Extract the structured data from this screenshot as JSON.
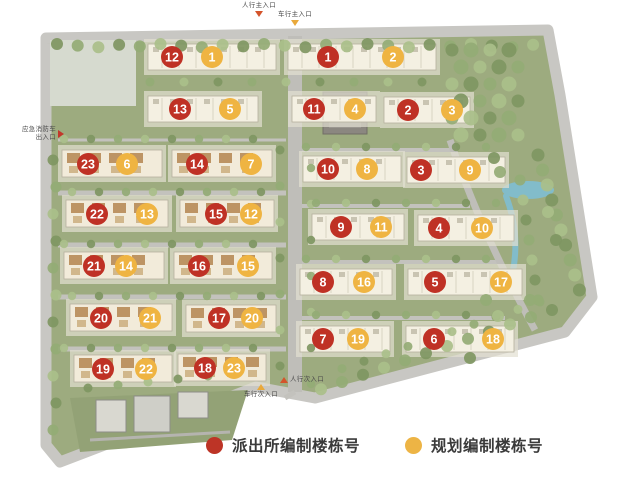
{
  "colors": {
    "red_marker": "#bf3125",
    "orange_marker": "#efb442",
    "legend_red": "#bd3426",
    "legend_orange": "#edb445",
    "pedestrian_triangle": "#d4542b",
    "vehicle_triangle": "#e9a93b",
    "emergency_triangle": "#c2372b"
  },
  "legend": {
    "items": [
      {
        "name": "police-numbering",
        "color": "#bd3426",
        "label": "派出所编制楼栋号"
      },
      {
        "name": "planning-numbering",
        "color": "#edb445",
        "label": "规划编制楼栋号"
      }
    ]
  },
  "entrances": [
    {
      "id": "pedestrian-main",
      "label": "人行主入口",
      "triangle": "down",
      "color": "#d4542b",
      "layout": "label-top",
      "x": 242,
      "y": 2
    },
    {
      "id": "vehicle-main",
      "label": "车行主入口",
      "triangle": "down",
      "color": "#e9a93b",
      "layout": "label-top",
      "x": 278,
      "y": 11
    },
    {
      "id": "emergency-fire",
      "label": "应急消防车出入口",
      "triangle": "right",
      "color": "#c2372b",
      "layout": "label-left",
      "x": 20,
      "y": 126
    },
    {
      "id": "pedestrian-secondary",
      "label": "人行次入口",
      "triangle": "up",
      "color": "#d4542b",
      "layout": "label-right",
      "x": 280,
      "y": 376
    },
    {
      "id": "vehicle-secondary",
      "label": "车行次入口",
      "triangle": "up",
      "color": "#e9a93b",
      "layout": "label-bottom",
      "x": 244,
      "y": 384
    }
  ],
  "map": {
    "buildings": [
      {
        "id": "T1L",
        "style": "large",
        "x": 148,
        "y": 44,
        "w": 128,
        "h": 26,
        "cy": 57,
        "red": {
          "n": "12",
          "cx": 172
        },
        "orange": {
          "n": "1",
          "cx": 212
        }
      },
      {
        "id": "T1R",
        "style": "large",
        "x": 288,
        "y": 44,
        "w": 148,
        "h": 26,
        "cy": 57,
        "red": {
          "n": "1",
          "cx": 328
        },
        "orange": {
          "n": "2",
          "cx": 393
        }
      },
      {
        "id": "T2L",
        "style": "large",
        "x": 148,
        "y": 96,
        "w": 110,
        "h": 26,
        "cy": 109,
        "red": {
          "n": "13",
          "cx": 180
        },
        "orange": {
          "n": "5",
          "cx": 230
        }
      },
      {
        "id": "T2M",
        "style": "large",
        "x": 292,
        "y": 96,
        "w": 84,
        "h": 26,
        "cy": 109,
        "red": {
          "n": "11",
          "cx": 314
        },
        "orange": {
          "n": "4",
          "cx": 355
        }
      },
      {
        "id": "T2R",
        "style": "large",
        "x": 384,
        "y": 97,
        "w": 86,
        "h": 26,
        "cy": 110,
        "red": {
          "n": "2",
          "cx": 408
        },
        "orange": {
          "n": "3",
          "cx": 452
        }
      },
      {
        "id": "R1L",
        "style": "large",
        "x": 303,
        "y": 156,
        "w": 98,
        "h": 26,
        "cy": 169,
        "red": {
          "n": "10",
          "cx": 328
        },
        "orange": {
          "n": "8",
          "cx": 367
        }
      },
      {
        "id": "R1R",
        "style": "large",
        "x": 407,
        "y": 157,
        "w": 98,
        "h": 26,
        "cy": 170,
        "red": {
          "n": "3",
          "cx": 421
        },
        "orange": {
          "n": "9",
          "cx": 470
        }
      },
      {
        "id": "R2L",
        "style": "large",
        "x": 312,
        "y": 214,
        "w": 92,
        "h": 26,
        "cy": 227,
        "red": {
          "n": "9",
          "cx": 341
        },
        "orange": {
          "n": "11",
          "cx": 381
        }
      },
      {
        "id": "R2R",
        "style": "large",
        "x": 418,
        "y": 215,
        "w": 96,
        "h": 26,
        "cy": 228,
        "red": {
          "n": "4",
          "cx": 439
        },
        "orange": {
          "n": "10",
          "cx": 482
        }
      },
      {
        "id": "R3L",
        "style": "large",
        "x": 300,
        "y": 269,
        "w": 92,
        "h": 26,
        "cy": 282,
        "red": {
          "n": "8",
          "cx": 323
        },
        "orange": {
          "n": "16",
          "cx": 364
        }
      },
      {
        "id": "R3R",
        "style": "large",
        "x": 408,
        "y": 269,
        "w": 114,
        "h": 26,
        "cy": 282,
        "red": {
          "n": "5",
          "cx": 435
        },
        "orange": {
          "n": "17",
          "cx": 501
        }
      },
      {
        "id": "R4L",
        "style": "large",
        "x": 300,
        "y": 326,
        "w": 90,
        "h": 26,
        "cy": 339,
        "red": {
          "n": "7",
          "cx": 323
        },
        "orange": {
          "n": "19",
          "cx": 358
        }
      },
      {
        "id": "R4R",
        "style": "large",
        "x": 406,
        "y": 326,
        "w": 108,
        "h": 26,
        "cy": 339,
        "red": {
          "n": "6",
          "cx": 434
        },
        "orange": {
          "n": "18",
          "cx": 493
        }
      },
      {
        "id": "L1A",
        "style": "small",
        "x": 62,
        "y": 150,
        "w": 100,
        "h": 27,
        "cy": 164,
        "red": {
          "n": "23",
          "cx": 88
        },
        "orange": {
          "n": "6",
          "cx": 127
        }
      },
      {
        "id": "L1B",
        "style": "small",
        "x": 172,
        "y": 150,
        "w": 100,
        "h": 27,
        "cy": 164,
        "red": {
          "n": "14",
          "cx": 197
        },
        "orange": {
          "n": "7",
          "cx": 251
        }
      },
      {
        "id": "L2A",
        "style": "small",
        "x": 66,
        "y": 200,
        "w": 102,
        "h": 27,
        "cy": 214,
        "red": {
          "n": "22",
          "cx": 97
        },
        "orange": {
          "n": "13",
          "cx": 147
        }
      },
      {
        "id": "L2B",
        "style": "small",
        "x": 180,
        "y": 200,
        "w": 94,
        "h": 27,
        "cy": 214,
        "red": {
          "n": "15",
          "cx": 216
        },
        "orange": {
          "n": "12",
          "cx": 251
        }
      },
      {
        "id": "L3A",
        "style": "small",
        "x": 64,
        "y": 252,
        "w": 100,
        "h": 27,
        "cy": 266,
        "red": {
          "n": "21",
          "cx": 94
        },
        "orange": {
          "n": "14",
          "cx": 126
        }
      },
      {
        "id": "L3B",
        "style": "small",
        "x": 174,
        "y": 252,
        "w": 98,
        "h": 27,
        "cy": 266,
        "red": {
          "n": "16",
          "cx": 199
        },
        "orange": {
          "n": "15",
          "cx": 248
        }
      },
      {
        "id": "L4A",
        "style": "small",
        "x": 70,
        "y": 304,
        "w": 102,
        "h": 27,
        "cy": 318,
        "red": {
          "n": "20",
          "cx": 101
        },
        "orange": {
          "n": "21",
          "cx": 150
        }
      },
      {
        "id": "L4B",
        "style": "small",
        "x": 186,
        "y": 305,
        "w": 90,
        "h": 27,
        "cy": 318,
        "red": {
          "n": "17",
          "cx": 219
        },
        "orange": {
          "n": "20",
          "cx": 252
        }
      },
      {
        "id": "L5A",
        "style": "small",
        "x": 74,
        "y": 355,
        "w": 98,
        "h": 27,
        "cy": 369,
        "red": {
          "n": "19",
          "cx": 103
        },
        "orange": {
          "n": "22",
          "cx": 146
        }
      },
      {
        "id": "L5B",
        "style": "small",
        "x": 178,
        "y": 354,
        "w": 88,
        "h": 27,
        "cy": 368,
        "red": {
          "n": "18",
          "cx": 205
        },
        "orange": {
          "n": "23",
          "cx": 234
        }
      }
    ]
  }
}
